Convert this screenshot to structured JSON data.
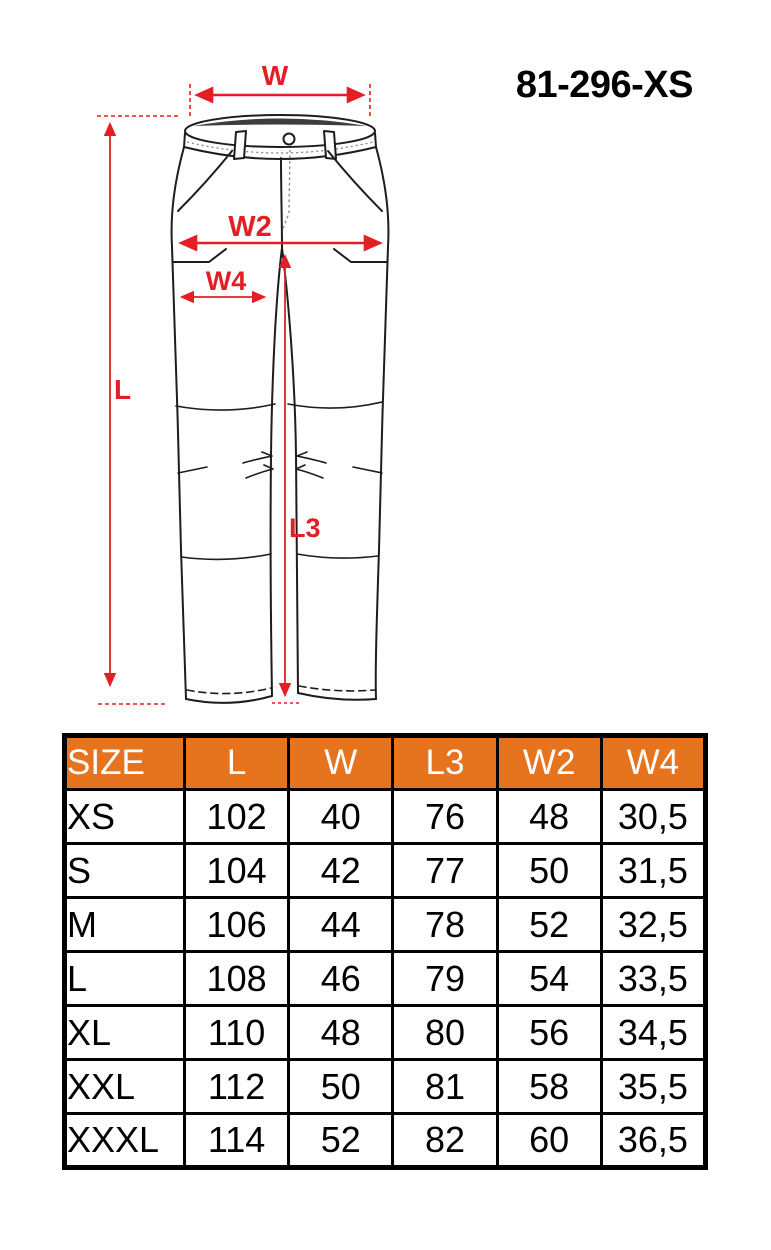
{
  "product_code": "81-296-XS",
  "diagram": {
    "description": "technical front-view drawing of work trousers with dimension arrows",
    "annotation_color": "#e31e24",
    "labels": {
      "w": "W",
      "w2": "W2",
      "w4": "W4",
      "l": "L",
      "l3": "L3"
    }
  },
  "table": {
    "header_bg": "#e6731e",
    "columns": [
      "SIZE",
      "L",
      "W",
      "L3",
      "W2",
      "W4"
    ],
    "rows": [
      [
        "XS",
        "102",
        "40",
        "76",
        "48",
        "30,5"
      ],
      [
        "S",
        "104",
        "42",
        "77",
        "50",
        "31,5"
      ],
      [
        "M",
        "106",
        "44",
        "78",
        "52",
        "32,5"
      ],
      [
        "L",
        "108",
        "46",
        "79",
        "54",
        "33,5"
      ],
      [
        "XL",
        "110",
        "48",
        "80",
        "56",
        "34,5"
      ],
      [
        "XXL",
        "112",
        "50",
        "81",
        "58",
        "35,5"
      ],
      [
        "XXXL",
        "114",
        "52",
        "82",
        "60",
        "36,5"
      ]
    ]
  }
}
